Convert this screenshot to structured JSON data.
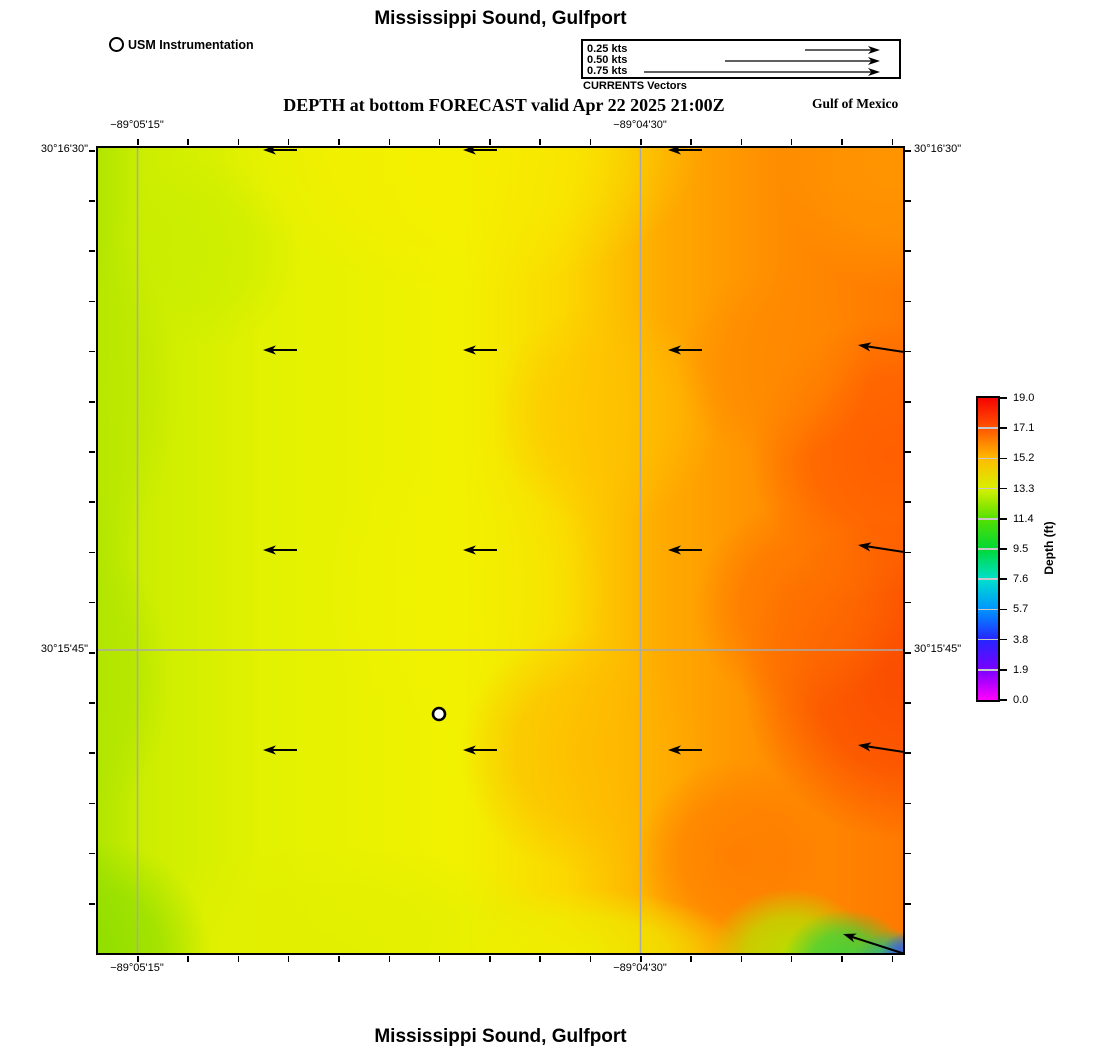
{
  "titles": {
    "top": "Mississippi Sound, Gulfport",
    "subtitle": "DEPTH at bottom FORECAST valid Apr 22 2025 21:00Z",
    "region": "Gulf of Mexico",
    "bottom": "Mississippi Sound, Gulfport"
  },
  "station_legend": {
    "label": "USM Instrumentation"
  },
  "vector_legend": {
    "caption": "CURRENTS Vectors",
    "items": [
      {
        "label": "0.25 kts",
        "tail_x": 222
      },
      {
        "label": "0.50 kts",
        "tail_x": 142
      },
      {
        "label": "0.75 kts",
        "tail_x": 61
      }
    ],
    "tip_x": 297,
    "row_y": [
      9,
      20,
      31
    ]
  },
  "map": {
    "axis": {
      "top_left": "−89°05'15\"",
      "top_right": "−89°04'30\"",
      "bottom_left": "−89°05'15\"",
      "bottom_right": "−89°04'30\"",
      "left_top": "30°16'30\"",
      "left_bottom": "30°15'45\"",
      "right_top": "30°16'30\"",
      "right_bottom": "30°15'45\""
    },
    "ticks": {
      "x": {
        "start": 137,
        "step": 50.3,
        "count": 16
      },
      "y": {
        "start": 150,
        "step": 50.2,
        "count": 16
      },
      "len": 6,
      "thickness": 1.5
    },
    "gridlines": {
      "x": [
        39.5,
        542.5
      ],
      "y": [
        502
      ],
      "color": "#a9a9a9",
      "width": 1.5
    }
  },
  "colorbar": {
    "title": "Depth (ft)",
    "tick_labels": [
      "19.0",
      "17.1",
      "15.2",
      "13.3",
      "11.4",
      "9.5",
      "7.6",
      "5.7",
      "3.8",
      "1.9",
      "0.0"
    ],
    "stops": [
      {
        "pos": 0.0,
        "color": "#f60400"
      },
      {
        "pos": 0.1,
        "color": "#ff5500"
      },
      {
        "pos": 0.2,
        "color": "#ffbb00"
      },
      {
        "pos": 0.3,
        "color": "#d8f000"
      },
      {
        "pos": 0.4,
        "color": "#55e000"
      },
      {
        "pos": 0.5,
        "color": "#00d835"
      },
      {
        "pos": 0.6,
        "color": "#00e0cc"
      },
      {
        "pos": 0.7,
        "color": "#0095ff"
      },
      {
        "pos": 0.8,
        "color": "#2525ff"
      },
      {
        "pos": 0.9,
        "color": "#7a00ff"
      },
      {
        "pos": 1.0,
        "color": "#ff00ff"
      }
    ],
    "divider_color": "#c8c8c8"
  },
  "chart_data": {
    "type": "heatmap",
    "title": "Mississippi Sound, Gulfport",
    "subtitle": "DEPTH at bottom FORECAST valid Apr 22 2025 21:00Z",
    "variable": "Depth (ft)",
    "colorbar_range": [
      0.0,
      19.0
    ],
    "colorbar_ticks": [
      19.0,
      17.1,
      15.2,
      13.3,
      11.4,
      9.5,
      7.6,
      5.7,
      3.8,
      1.9,
      0.0
    ],
    "x_axis": {
      "labels": [
        "−89°05'15\"",
        "−89°04'30\""
      ],
      "label_px": [
        137,
        640
      ]
    },
    "y_axis": {
      "labels": [
        "30°16'30\"",
        "30°15'45\""
      ],
      "label_px": [
        150,
        650
      ]
    },
    "depth_field": {
      "size": 805,
      "base_stops": [
        {
          "pos": 0.0,
          "color": "#b2e600"
        },
        {
          "pos": 0.06,
          "color": "#cdee00"
        },
        {
          "pos": 0.2,
          "color": "#e2f200"
        },
        {
          "pos": 0.45,
          "color": "#f2f200"
        },
        {
          "pos": 0.58,
          "color": "#fcd800"
        },
        {
          "pos": 0.7,
          "color": "#ffab00"
        },
        {
          "pos": 0.85,
          "color": "#ff8c00"
        },
        {
          "pos": 1.0,
          "color": "#ff7a00"
        }
      ],
      "blobs": [
        {
          "x": 13,
          "y": 13,
          "r": 12,
          "sy": 1,
          "color": "#c6ee00",
          "a": 0.6
        },
        {
          "x": 45,
          "y": 55,
          "r": 18,
          "sy": 1,
          "color": "#f2f200",
          "a": 0.55
        },
        {
          "x": 45,
          "y": 0,
          "r": 30,
          "sy": 0.6,
          "color": "#f7ef00",
          "a": 0.75
        },
        {
          "x": 63,
          "y": 33,
          "r": 14,
          "sy": 1,
          "color": "#ffc300",
          "a": 0.7
        },
        {
          "x": 60,
          "y": 75,
          "r": 15,
          "sy": 1,
          "color": "#ffb400",
          "a": 0.65
        },
        {
          "x": 100,
          "y": 2,
          "r": 16,
          "sy": 1,
          "color": "#ff9a00",
          "a": 0.85
        },
        {
          "x": 98,
          "y": 38,
          "r": 17,
          "sy": 1,
          "color": "#ff5a00",
          "a": 0.85
        },
        {
          "x": 100,
          "y": 66,
          "r": 20,
          "sy": 1,
          "color": "#fb4800",
          "a": 0.9
        },
        {
          "x": 87,
          "y": 57,
          "r": 13,
          "sy": 1,
          "color": "#ff6f00",
          "a": 0.75
        },
        {
          "x": 84,
          "y": 27,
          "r": 12,
          "sy": 1,
          "color": "#ff8800",
          "a": 0.7
        },
        {
          "x": 79,
          "y": 88,
          "r": 12,
          "sy": 1,
          "color": "#ff7a00",
          "a": 0.8
        },
        {
          "x": 30,
          "y": 100,
          "r": 30,
          "sy": 0.45,
          "color": "#e2f000",
          "a": 0.9
        },
        {
          "x": 60,
          "y": 100,
          "r": 20,
          "sy": 0.4,
          "color": "#eef000",
          "a": 0.85
        },
        {
          "x": 0,
          "y": 100,
          "r": 14,
          "sy": 1,
          "color": "#8ede00",
          "a": 0.9
        },
        {
          "x": 0,
          "y": 30,
          "r": 10,
          "sy": 2,
          "color": "#bce800",
          "a": 0.85
        },
        {
          "x": 0,
          "y": 66,
          "r": 9,
          "sy": 1.8,
          "color": "#b2e600",
          "a": 0.85
        },
        {
          "x": 86,
          "y": 100,
          "r": 10,
          "sy": 0.8,
          "color": "#b4e600",
          "a": 0.9
        },
        {
          "x": 93,
          "y": 101,
          "r": 8,
          "sy": 0.8,
          "color": "#3cd23c",
          "a": 0.95
        },
        {
          "x": 99,
          "y": 102,
          "r": 5.5,
          "sy": 0.9,
          "color": "#28b48c",
          "a": 0.95
        },
        {
          "x": 100.5,
          "y": 101,
          "r": 3.6,
          "sy": 1,
          "color": "#3c5ae6",
          "a": 1
        }
      ]
    },
    "current_vectors": {
      "units": "kts",
      "legend_speeds": [
        0.25,
        0.5,
        0.75
      ],
      "direction": "west",
      "arrows": [
        {
          "t": [
            199,
            2
          ],
          "h": [
            165,
            2
          ]
        },
        {
          "t": [
            399,
            2
          ],
          "h": [
            365,
            2
          ]
        },
        {
          "t": [
            604,
            2
          ],
          "h": [
            570,
            2
          ]
        },
        {
          "t": [
            199,
            202
          ],
          "h": [
            165,
            202
          ]
        },
        {
          "t": [
            399,
            202
          ],
          "h": [
            365,
            202
          ]
        },
        {
          "t": [
            604,
            202
          ],
          "h": [
            570,
            202
          ]
        },
        {
          "t": [
            806,
            204
          ],
          "h": [
            760,
            197
          ]
        },
        {
          "t": [
            199,
            402
          ],
          "h": [
            165,
            402
          ]
        },
        {
          "t": [
            399,
            402
          ],
          "h": [
            365,
            402
          ]
        },
        {
          "t": [
            604,
            402
          ],
          "h": [
            570,
            402
          ]
        },
        {
          "t": [
            806,
            404
          ],
          "h": [
            760,
            397
          ]
        },
        {
          "t": [
            199,
            602
          ],
          "h": [
            165,
            602
          ]
        },
        {
          "t": [
            399,
            602
          ],
          "h": [
            365,
            602
          ]
        },
        {
          "t": [
            604,
            602
          ],
          "h": [
            570,
            602
          ]
        },
        {
          "t": [
            806,
            604
          ],
          "h": [
            760,
            597
          ]
        },
        {
          "t": [
            807,
            806
          ],
          "h": [
            745,
            786
          ]
        }
      ]
    },
    "station": {
      "name": "USM Instrumentation",
      "x": 341,
      "y": 566
    }
  }
}
